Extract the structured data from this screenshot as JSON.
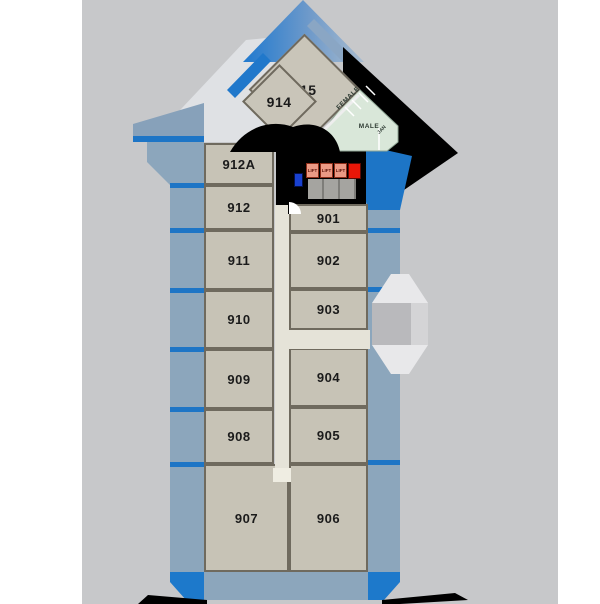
{
  "rooms": {
    "left": [
      "912A",
      "912",
      "911",
      "910",
      "909",
      "908",
      "907"
    ],
    "right": [
      "901",
      "902",
      "903",
      "904",
      "905",
      "906"
    ],
    "diamond": [
      "915",
      "914"
    ]
  },
  "restrooms": {
    "female": "FEMALE",
    "male": "MALE",
    "janitor": "JAN"
  },
  "lifts": [
    "LIFT",
    "LIFT",
    "LIFT"
  ],
  "colors": {
    "accent_blue": "#1d75c6",
    "muted_blue": "#8ca6bc",
    "room_fill": "#c7c3b6",
    "room_border": "#6f6a5e",
    "corridor": "#e5e3d8",
    "restroom_mint": "#d9e7d9",
    "lift_salmon": "#eb9a85",
    "alarm_red": "#e81607",
    "service_blue": "#1941cf",
    "shadow_black": "#000000",
    "canvas_gray": "#c7c8ca"
  }
}
